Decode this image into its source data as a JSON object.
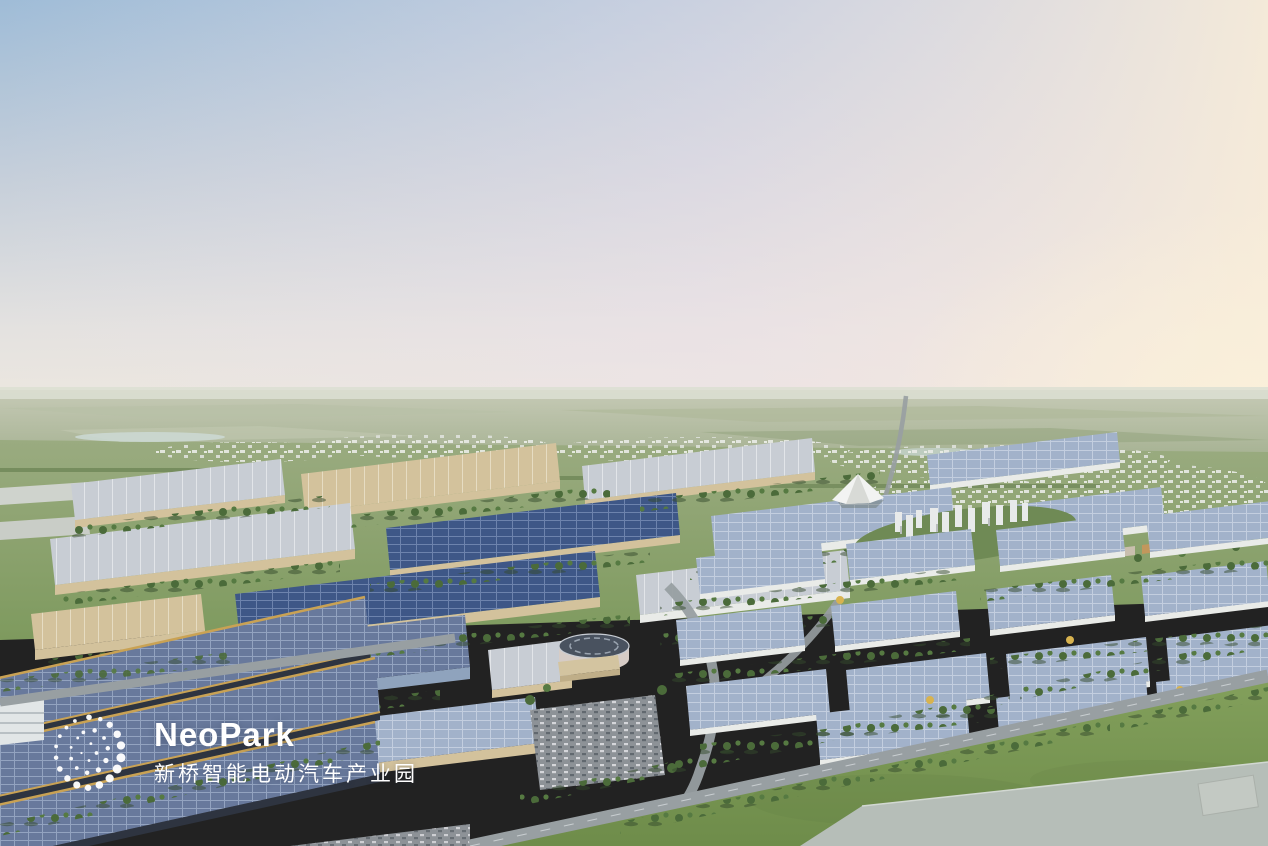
{
  "image": {
    "kind": "aerial-architectural-rendering",
    "subject": "NeoPark smart electric-vehicle industrial park at dusk",
    "width_px": 1268,
    "height_px": 846
  },
  "logo": {
    "name": "NeoPark",
    "chinese": "新桥智能电动汽车产业园",
    "text_color": "#ffffff",
    "icon": "dot-cluster-icon"
  },
  "palette": {
    "sky_top": "#9fbcd7",
    "sky_mid": "#c6cfda",
    "sky_warm_right": "#f8ecd9",
    "sky_pink": "#eee4e8",
    "horizon_haze": "#dcdfd2",
    "far_field": "#a2af8e",
    "mid_field": "#7e9a5e",
    "grass_foreground": "#76954f",
    "tree": "#4b6b3a",
    "tree_autumn": "#d8b34f",
    "roof_gray": "#c8cdd4",
    "wall_beige": "#d3c29c",
    "solar_dark": "#3e5787",
    "solar_mid": "#68799c",
    "solar_light": "#a2b2ca",
    "road": "#989fa2",
    "water": "#ccd8d4",
    "building_white": "#e8eaea",
    "gold_trim": "#c9a254"
  },
  "scene": {
    "regions": [
      "sky",
      "horizon-fields",
      "distant-city",
      "main-avenue",
      "factory-complex",
      "warehouse-district",
      "residential-cluster",
      "campus-buildings",
      "tent-canopy",
      "round-building",
      "parking-lot",
      "solar-halls-foreground",
      "boulevard",
      "foreground-grass",
      "gray-slab-building"
    ]
  }
}
